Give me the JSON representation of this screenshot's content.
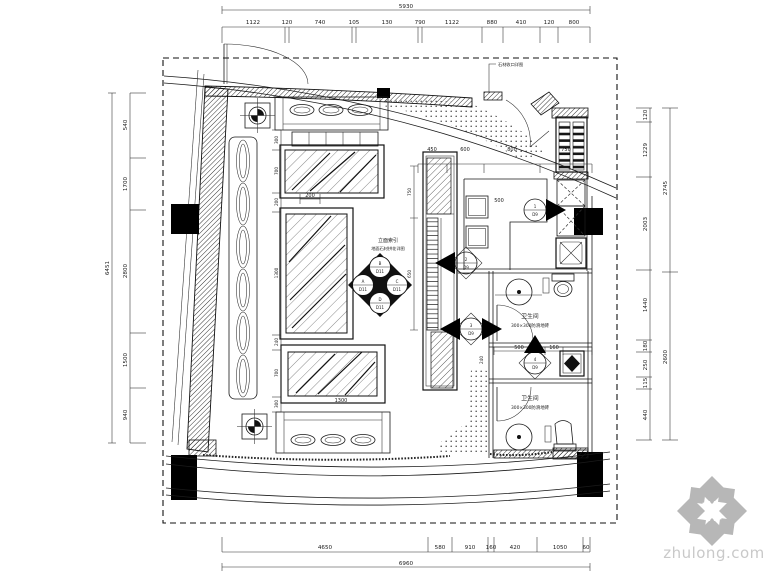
{
  "watermark": {
    "brand": "zhulong.com"
  },
  "annotations": {
    "entry_note": "石材收口详图",
    "index_title_1": "立面索引",
    "index_title_2": "地面石材拼花详图"
  },
  "rooms": {
    "toilet_upper": {
      "name": "卫生间",
      "finish": "300×300防滑地砖"
    },
    "toilet_lower": {
      "name": "卫生间",
      "finish": "300×300防滑地砖"
    }
  },
  "callout": {
    "top": {
      "num": "B",
      "sheet": "D11"
    },
    "left": {
      "num": "A",
      "sheet": "D11"
    },
    "right": {
      "num": "C",
      "sheet": "D11"
    },
    "bottom": {
      "num": "D",
      "sheet": "D11"
    }
  },
  "markers": {
    "m1": {
      "num": "1",
      "sheet": "D9"
    },
    "m2": {
      "num": "2",
      "sheet": "D9"
    },
    "m3": {
      "num": "3",
      "sheet": "D9"
    },
    "m4": {
      "num": "4",
      "sheet": "D9"
    }
  },
  "dims": {
    "top": {
      "total": "5930",
      "segments": [
        "1122",
        "120",
        "740",
        "105",
        "130",
        "790",
        "1122",
        "880",
        "410",
        "120",
        "800"
      ]
    },
    "left": {
      "total": "6451",
      "segments": [
        "540",
        "1700",
        "2800",
        "1500",
        "940"
      ]
    },
    "right": {
      "inner": [
        "120",
        "1229",
        "2003",
        "1440",
        "180",
        "250",
        "115",
        "440"
      ],
      "outer": [
        "2745",
        "2600"
      ]
    },
    "bottom": {
      "total": "6960",
      "segments": [
        "4650",
        "580",
        "910",
        "160",
        "420",
        "1050",
        "60"
      ]
    },
    "interior": {
      "top_row": [
        "450",
        "600",
        "800",
        "750"
      ],
      "left_col": [
        "300",
        "700",
        "200",
        "1300",
        "240",
        "700",
        "300"
      ],
      "gap": "200",
      "stool_dim": "500",
      "table_dim": "1300",
      "bar_col": [
        "750",
        "650"
      ],
      "corridor": [
        "240",
        "500",
        "160"
      ]
    }
  }
}
